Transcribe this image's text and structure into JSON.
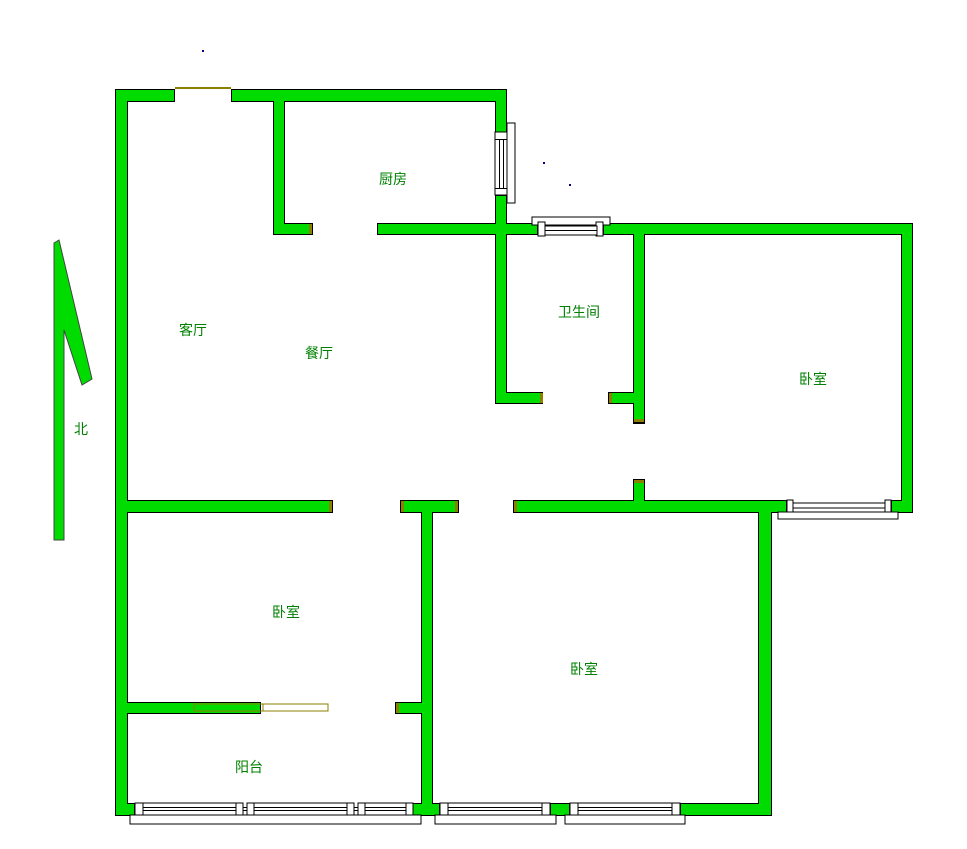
{
  "colors": {
    "wall": "#00dc00",
    "outline": "#000000",
    "cap": "#8b8000",
    "window": "#ffffff",
    "label": "#008000",
    "arrow_outline": "#444444",
    "dot": "#000080"
  },
  "rooms": [
    {
      "id": "kitchen",
      "label": "厨房"
    },
    {
      "id": "living-room",
      "label": "客厅"
    },
    {
      "id": "dining-room",
      "label": "餐厅"
    },
    {
      "id": "bathroom",
      "label": "卫生间"
    },
    {
      "id": "bedroom-top-right",
      "label": "卧室"
    },
    {
      "id": "bedroom-bottom-left",
      "label": "卧室"
    },
    {
      "id": "bedroom-bottom-right",
      "label": "卧室"
    },
    {
      "id": "balcony",
      "label": "阳台"
    }
  ],
  "compass": {
    "label": "北"
  }
}
